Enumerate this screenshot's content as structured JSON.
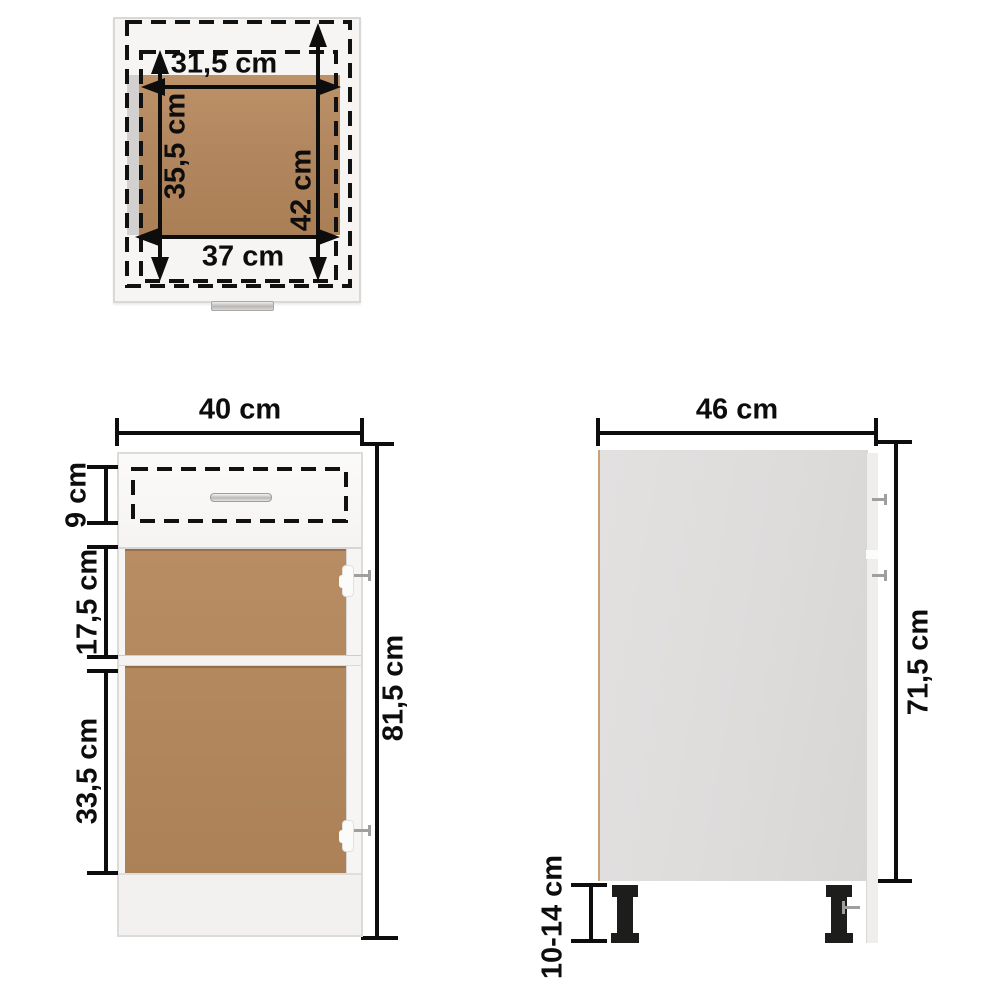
{
  "views": {
    "top": {
      "labels": {
        "inner_width": "31,5 cm",
        "inner_depth": "35,5 cm",
        "outer_depth": "42 cm",
        "outer_width": "37 cm"
      }
    },
    "front": {
      "labels": {
        "width": "40 cm",
        "drawer_height": "9 cm",
        "upper_compartment": "17,5 cm",
        "lower_compartment": "33,5 cm",
        "total_height": "81,5 cm"
      }
    },
    "side": {
      "labels": {
        "depth": "46 cm",
        "body_height": "71,5 cm",
        "leg_height": "10-14 cm"
      }
    }
  },
  "colors": {
    "background": "#ffffff",
    "dimension_ink": "#0d0d0d",
    "wood_brown": "#b2875f",
    "panel_gray": "#dedcdb",
    "cabinet_white": "#f8f7f6",
    "handle_silver": "#c6c6c6",
    "leg_black": "#1d1d1c",
    "edge_tan": "#c9a179"
  }
}
